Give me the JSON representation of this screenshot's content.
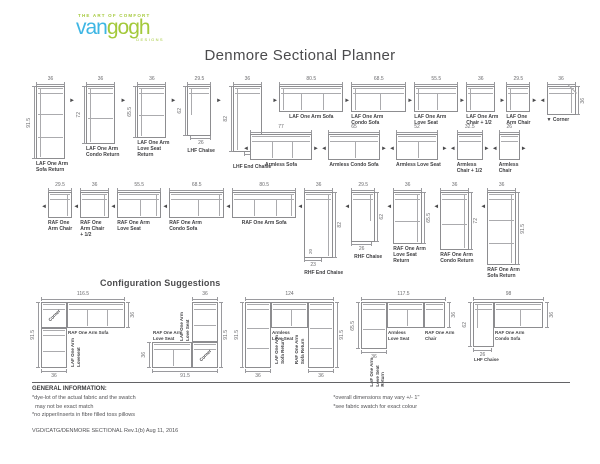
{
  "logo": {
    "tagline": "THE ART OF COMFORT",
    "name_left": "van",
    "name_right": "gogh",
    "designs": "DESIGNS",
    "color_blue": "#3eb6e4",
    "color_green": "#a4c93b"
  },
  "title": "Denmore Sectional Planner",
  "planner": {
    "rows": [
      {
        "name": "laf-and-lhf-pieces-row",
        "items": [
          {
            "label": [
              "LAF One Arm",
              "Sofa Return"
            ],
            "type": "v-return",
            "arm": "left",
            "w": 36,
            "h": 91.5,
            "seats": 3,
            "dims": {
              "top": "36",
              "left": "91.5"
            }
          },
          {
            "arrow": "right"
          },
          {
            "label": [
              "LAF One Arm",
              "Condo Return"
            ],
            "type": "v-return",
            "arm": "left",
            "w": 36,
            "h": 72,
            "seats": 2,
            "dims": {
              "top": "36",
              "left": "72"
            }
          },
          {
            "arrow": "right"
          },
          {
            "label": [
              "LAF One Arm",
              "Love Seat",
              "Return"
            ],
            "type": "v-return",
            "arm": "left",
            "w": 36,
            "h": 65.5,
            "seats": 2,
            "dims": {
              "top": "36",
              "left": "65.5"
            }
          },
          {
            "arrow": "right"
          },
          {
            "label": [
              "LHF Chaise"
            ],
            "type": "chaise",
            "arm": "left",
            "w": 29.5,
            "h": 62,
            "dims": {
              "top": "29.5",
              "left": "62",
              "bottom": "26"
            }
          },
          {
            "arrow": "right"
          },
          {
            "label": [
              "LHF End Chaise"
            ],
            "type": "end-chaise",
            "arm": "left",
            "w": 36,
            "h": 82,
            "dims": {
              "top": "36",
              "left": "82",
              "bottom": "23",
              "inner": "20"
            }
          },
          {
            "arrow": "right"
          },
          {
            "label": [
              "LAF One Arm Sofa"
            ],
            "type": "h",
            "arm": "left",
            "w": 80.5,
            "seats": 3,
            "dims": {
              "top": "80.5"
            }
          },
          {
            "arrow": "right"
          },
          {
            "label": [
              "LAF One Arm",
              "Condo Sofa"
            ],
            "type": "h",
            "arm": "left",
            "w": 68.5,
            "seats": 2,
            "dims": {
              "top": "68.5"
            }
          },
          {
            "arrow": "right"
          },
          {
            "label": [
              "LAF One Arm",
              "Love Seat"
            ],
            "type": "h",
            "arm": "left",
            "w": 55.5,
            "seats": 2,
            "dims": {
              "top": "55.5"
            }
          },
          {
            "arrow": "right"
          },
          {
            "label": [
              "LAF One Arm",
              "Chair + 1/2"
            ],
            "type": "h",
            "arm": "left",
            "w": 36,
            "seats": 1,
            "dims": {
              "top": "36"
            }
          },
          {
            "arrow": "right"
          },
          {
            "label": [
              "LAF One",
              "Arm Chair"
            ],
            "type": "h",
            "arm": "left",
            "w": 29.5,
            "seats": 1,
            "dims": {
              "top": "29.5"
            }
          },
          {
            "arrow": "right"
          },
          {
            "arrow": "left"
          },
          {
            "label": [
              "Corner"
            ],
            "type": "corner",
            "arm": "right",
            "w": 36,
            "down_arrow": true,
            "dims": {
              "top": "36",
              "right": "36"
            }
          }
        ]
      },
      {
        "name": "armless-pieces-row",
        "items": [
          {
            "arrow": "left"
          },
          {
            "label": [
              "Armless Sofa"
            ],
            "type": "h",
            "w": 77,
            "seats": 3,
            "dims": {
              "top": "77"
            }
          },
          {
            "arrow": "right"
          },
          {
            "arrow": "left"
          },
          {
            "label": [
              "Armless Condo Sofa"
            ],
            "type": "h",
            "w": 65,
            "seats": 2,
            "dims": {
              "top": "65"
            }
          },
          {
            "arrow": "right"
          },
          {
            "arrow": "left"
          },
          {
            "label": [
              "Armless Love Seat"
            ],
            "type": "h",
            "w": 52,
            "seats": 2,
            "dims": {
              "top": "52"
            }
          },
          {
            "arrow": "right"
          },
          {
            "arrow": "left"
          },
          {
            "label": [
              "Armless",
              "Chair + 1/2"
            ],
            "type": "h",
            "w": 32.5,
            "seats": 1,
            "dims": {
              "top": "32.5"
            }
          },
          {
            "arrow": "right"
          },
          {
            "arrow": "left"
          },
          {
            "label": [
              "Armless",
              "Chair"
            ],
            "type": "h",
            "w": 26,
            "seats": 1,
            "dims": {
              "top": "26"
            }
          },
          {
            "arrow": "right"
          }
        ]
      },
      {
        "name": "raf-and-rhf-pieces-row",
        "items": [
          {
            "arrow": "left"
          },
          {
            "label": [
              "RAF One",
              "Arm Chair"
            ],
            "type": "h",
            "arm": "right",
            "w": 29.5,
            "seats": 1,
            "dims": {
              "top": "29.5"
            }
          },
          {
            "arrow": "left"
          },
          {
            "label": [
              "RAF One",
              "Arm Chair",
              "+ 1/2"
            ],
            "type": "h",
            "arm": "right",
            "w": 36,
            "seats": 1,
            "dims": {
              "top": "36"
            }
          },
          {
            "arrow": "left"
          },
          {
            "label": [
              "RAF One Arm",
              "Love Seat"
            ],
            "type": "h",
            "arm": "right",
            "w": 55.5,
            "seats": 2,
            "dims": {
              "top": "55.5"
            }
          },
          {
            "arrow": "left"
          },
          {
            "label": [
              "RAF One Arm",
              "Condo Sofa"
            ],
            "type": "h",
            "arm": "right",
            "w": 68.5,
            "seats": 2,
            "dims": {
              "top": "68.5"
            }
          },
          {
            "arrow": "left"
          },
          {
            "label": [
              "RAF One Arm Sofa"
            ],
            "type": "h",
            "arm": "right",
            "w": 80.5,
            "seats": 3,
            "dims": {
              "top": "80.5"
            }
          },
          {
            "arrow": "left"
          },
          {
            "label": [
              "RHF End Chaise"
            ],
            "type": "end-chaise",
            "arm": "right",
            "w": 36,
            "h": 82,
            "dims": {
              "top": "36",
              "right": "82",
              "bottom": "23",
              "inner": "20"
            }
          },
          {
            "arrow": "left"
          },
          {
            "label": [
              "RHF Chaise"
            ],
            "type": "chaise",
            "arm": "right",
            "w": 29.5,
            "h": 62,
            "dims": {
              "top": "29.5",
              "right": "62",
              "bottom": "26"
            }
          },
          {
            "arrow": "left"
          },
          {
            "label": [
              "RAF One Arm",
              "Love Seat",
              "Return"
            ],
            "type": "v-return",
            "arm": "right",
            "w": 36,
            "h": 65.5,
            "seats": 2,
            "dims": {
              "top": "36",
              "right": "65.5"
            }
          },
          {
            "arrow": "left"
          },
          {
            "label": [
              "RAF One Arm",
              "Condo Return"
            ],
            "type": "v-return",
            "arm": "right",
            "w": 36,
            "h": 72,
            "seats": 2,
            "dims": {
              "top": "36",
              "right": "72"
            }
          },
          {
            "arrow": "left"
          },
          {
            "label": [
              "RAF One Arm",
              "Sofa Return"
            ],
            "type": "v-return",
            "arm": "right",
            "w": 36,
            "h": 91.5,
            "seats": 3,
            "dims": {
              "top": "36",
              "right": "91.5"
            }
          }
        ]
      }
    ]
  },
  "configurations": {
    "heading": "Configuration Suggestions",
    "items": [
      {
        "name": "config-1",
        "w": 116.5,
        "h": 91.5,
        "pieces": [
          {
            "label": [
              "Corner"
            ],
            "type": "corner",
            "x": 0,
            "y": 0,
            "w": 36,
            "h": 36,
            "labelPos": "diag"
          },
          {
            "label": [
              "RAF One Arm Sofa"
            ],
            "type": "h",
            "seats": 3,
            "x": 36,
            "y": 0,
            "w": 80.5,
            "h": 36,
            "labelPos": "below"
          },
          {
            "label": [
              "LAF One Arm",
              "Loveseat"
            ],
            "type": "v",
            "seats": 2,
            "x": 0,
            "y": 36,
            "w": 36,
            "h": 55.5,
            "labelPos": "right-v"
          }
        ],
        "dims": [
          {
            "text": "116.5",
            "side": "top",
            "x": 0,
            "len": 116.5
          },
          {
            "text": "91.5",
            "side": "left",
            "y": 0,
            "len": 91.5
          },
          {
            "text": "36",
            "side": "right",
            "y": 0,
            "len": 36
          },
          {
            "text": "36",
            "side": "bottom",
            "x": 0,
            "len": 36
          }
        ]
      },
      {
        "name": "config-2",
        "w": 91.5,
        "h": 91.5,
        "pieces": [
          {
            "label": [
              "LAF One Arm",
              "Love Seat"
            ],
            "type": "v",
            "seats": 2,
            "x": 55.5,
            "y": 0,
            "w": 36,
            "h": 55.5,
            "labelPos": "left-v"
          },
          {
            "label": [
              "Corner"
            ],
            "type": "corner",
            "x": 55.5,
            "y": 55.5,
            "w": 36,
            "h": 36,
            "labelPos": "diag"
          },
          {
            "label": [
              "RAF One Arm",
              "Love Seat"
            ],
            "type": "h",
            "seats": 2,
            "x": 0,
            "y": 55.5,
            "w": 55.5,
            "h": 36,
            "labelPos": "above"
          }
        ],
        "dims": [
          {
            "text": "36",
            "side": "top",
            "x": 55.5,
            "len": 36
          },
          {
            "text": "91.5",
            "side": "right",
            "y": 0,
            "len": 91.5
          },
          {
            "text": "91.5",
            "side": "bottom",
            "x": 0,
            "len": 91.5
          },
          {
            "text": "36",
            "side": "left",
            "y": 55.5,
            "len": 36
          }
        ]
      },
      {
        "name": "config-3",
        "w": 124,
        "h": 91.5,
        "pieces": [
          {
            "label": [
              "LAF One Arm",
              "Sofa Return"
            ],
            "type": "v",
            "seats": 3,
            "x": 0,
            "y": 0,
            "w": 36,
            "h": 91.5,
            "labelPos": "right-v"
          },
          {
            "label": [
              "Armless",
              "Love Seat"
            ],
            "type": "h",
            "seats": 2,
            "x": 36,
            "y": 0,
            "w": 52,
            "h": 36,
            "labelPos": "below"
          },
          {
            "label": [
              "RAF One Arm",
              "Sofa Return"
            ],
            "type": "v",
            "seats": 3,
            "x": 88,
            "y": 0,
            "w": 36,
            "h": 91.5,
            "labelPos": "left-v"
          }
        ],
        "dims": [
          {
            "text": "124",
            "side": "top",
            "x": 0,
            "len": 124
          },
          {
            "text": "91.5",
            "side": "left",
            "y": 0,
            "len": 91.5
          },
          {
            "text": "91.5",
            "side": "right",
            "y": 0,
            "len": 91.5
          },
          {
            "text": "36",
            "side": "bottom",
            "x": 0,
            "len": 36
          },
          {
            "text": "36",
            "side": "bottom",
            "x": 88,
            "len": 36
          }
        ]
      },
      {
        "name": "config-4",
        "w": 117.5,
        "h": 65.5,
        "pieces": [
          {
            "label": [
              "LAF One Arm",
              "Love Seat",
              "Return"
            ],
            "type": "v",
            "seats": 2,
            "x": 0,
            "y": 0,
            "w": 36,
            "h": 65.5,
            "labelPos": "below-v"
          },
          {
            "label": [
              "Armless",
              "Love Seat"
            ],
            "type": "h",
            "seats": 2,
            "x": 36,
            "y": 0,
            "w": 52,
            "h": 36,
            "labelPos": "below"
          },
          {
            "label": [
              "RAF One Arm",
              "Chair"
            ],
            "type": "h",
            "seats": 1,
            "x": 88,
            "y": 0,
            "w": 29.5,
            "h": 36,
            "labelPos": "below"
          }
        ],
        "dims": [
          {
            "text": "117.5",
            "side": "top",
            "x": 0,
            "len": 117.5
          },
          {
            "text": "65.5",
            "side": "left",
            "y": 0,
            "len": 65.5
          },
          {
            "text": "36",
            "side": "right",
            "y": 0,
            "len": 36
          },
          {
            "text": "36",
            "side": "bottom",
            "x": 0,
            "len": 36
          }
        ]
      },
      {
        "name": "config-5",
        "w": 98,
        "h": 62,
        "pieces": [
          {
            "label": [
              "LHF Chaise"
            ],
            "type": "chaise",
            "arm": "left",
            "x": 0,
            "y": 0,
            "w": 29.5,
            "h": 62,
            "labelPos": "below8"
          },
          {
            "label": [
              "RAF One Arm",
              "Condo Sofa"
            ],
            "type": "h",
            "seats": 2,
            "x": 29.5,
            "y": 0,
            "w": 68.5,
            "h": 36,
            "labelPos": "below"
          }
        ],
        "dims": [
          {
            "text": "98",
            "side": "top",
            "x": 0,
            "len": 98
          },
          {
            "text": "62",
            "side": "left",
            "y": 0,
            "len": 62
          },
          {
            "text": "36",
            "side": "right",
            "y": 0,
            "len": 36
          },
          {
            "text": "26",
            "side": "bottom",
            "x": 0,
            "len": 26
          }
        ]
      }
    ]
  },
  "general_info": {
    "heading": "GENERAL INFORMATION:",
    "col1": [
      "*dye-lot of the actual fabric and the swatch",
      "  may not be exact match",
      "*no zipper/inserts in fibre filled toss pillows"
    ],
    "col2": [
      "*overall dimensions may vary +/- 1\"",
      "*see fabric swatch for exact colour"
    ]
  },
  "footer": "VGD/CATG/DENMORE SECTIONAL Rev.1(b) Aug 11, 2016"
}
